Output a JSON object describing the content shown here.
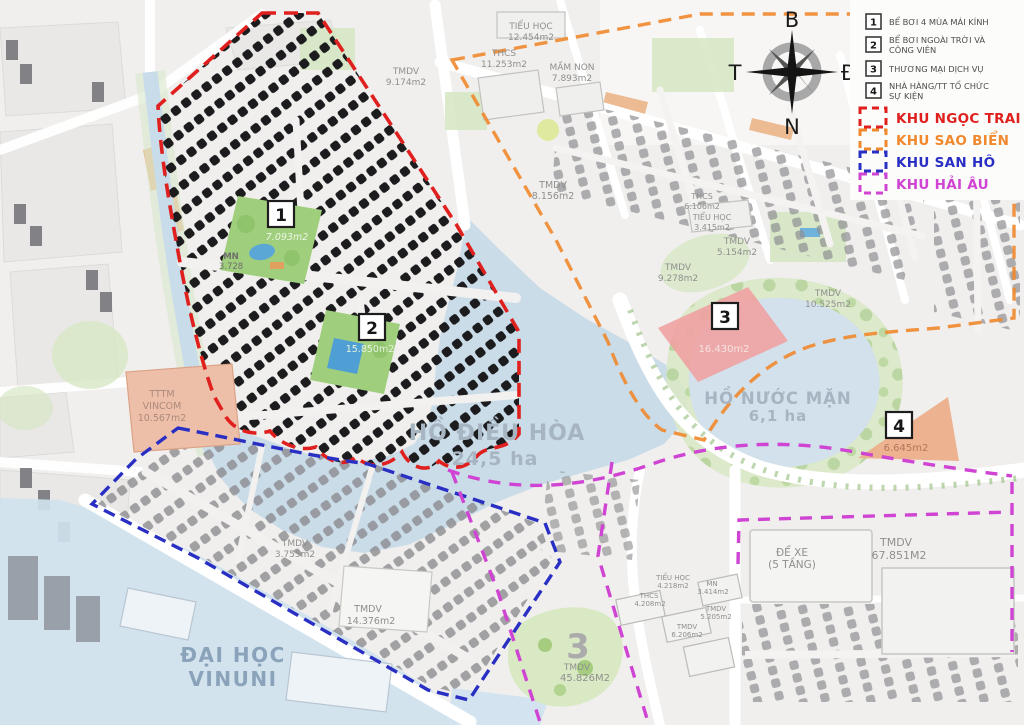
{
  "legend": {
    "items": [
      {
        "num": "1",
        "lines": [
          "BỂ BƠI 4 MÙA MÁI KÍNH"
        ]
      },
      {
        "num": "2",
        "lines": [
          "BỂ BƠI NGOÀI TRỜI VÀ",
          "CÔNG VIÊN"
        ]
      },
      {
        "num": "3",
        "lines": [
          "THƯƠNG MẠI DỊCH VỤ"
        ]
      },
      {
        "num": "4",
        "lines": [
          "NHÀ HÀNG/TT TỔ CHỨC",
          "SỰ KIỆN"
        ]
      }
    ],
    "zones": [
      {
        "label": "KHU NGỌC TRAI",
        "color": "#df201e"
      },
      {
        "label": "KHU SAO BIỂN",
        "color": "#f0882e"
      },
      {
        "label": "KHU SAN HÔ",
        "color": "#2a2fc4"
      },
      {
        "label": "KHU HẢI ÂU",
        "color": "#cf44d2"
      }
    ]
  },
  "compass": {
    "n": "B",
    "e": "Đ",
    "s": "N",
    "w": "T"
  },
  "lakes": {
    "dieu_hoa": {
      "name": "HỒ ĐIỀU HÒA",
      "area": "24,5 ha"
    },
    "nuoc_man": {
      "name": "HỒ NƯỚC MẶN",
      "area": "6,1 ha"
    }
  },
  "markers": {
    "m1": {
      "num": "1",
      "area": "7.093m2"
    },
    "m2": {
      "num": "2",
      "area": "15.850m2"
    },
    "m3": {
      "num": "3",
      "area": "16.430m2"
    },
    "m4": {
      "num": "4",
      "area": "6.645m2"
    },
    "m3b": {
      "num": "3",
      "name": "TMDV",
      "area": "45.826M2"
    }
  },
  "parcels": {
    "tieu_hoc_12454": {
      "line1": "TIỂU HỌC",
      "line2": "12.454m2"
    },
    "thcs_11253": {
      "line1": "THCS",
      "line2": "11.253m2"
    },
    "mam_non_7893": {
      "line1": "MẦM NON",
      "line2": "7.893m2"
    },
    "tmdv_9174": {
      "line1": "TMDV",
      "line2": "9.174m2"
    },
    "tmdv_8156": {
      "line1": "TMDV",
      "line2": "8.156m2"
    },
    "thcs_6106": {
      "line1": "THCS",
      "line2": "6.106m2"
    },
    "tieu_hoc_3415": {
      "line1": "TIỂU HỌC",
      "line2": "3.415m2"
    },
    "tmdv_5154": {
      "line1": "TMDV",
      "line2": "5.154m2"
    },
    "tmdv_9278": {
      "line1": "TMDV",
      "line2": "9.278m2"
    },
    "tmdv_10525": {
      "line1": "TMDV",
      "line2": "10.525m2"
    },
    "mn_3728": {
      "line1": "MN",
      "line2": "3.728"
    },
    "tttm_vincom": {
      "line1": "TTTM",
      "line2": "VINCOM",
      "line3": "10.567m2"
    },
    "tmdv_3755": {
      "line1": "TMDV",
      "line2": "3.755m2"
    },
    "tmdv_14376": {
      "line1": "TMDV",
      "line2": "14.376m2"
    },
    "dai_hoc_vinuni": {
      "line1": "ĐẠI HỌC",
      "line2": "VINUNI"
    },
    "thcs_4208": {
      "line1": "THCS",
      "line2": "4.208m2"
    },
    "tieu_hoc_4218": {
      "line1": "TIỂU HỌC",
      "line2": "4.218m2"
    },
    "mn_3414": {
      "line1": "MN",
      "line2": "3.414m2"
    },
    "tmdv_5205": {
      "line1": "TMDV",
      "line2": "5.205m2"
    },
    "tmdv_6206": {
      "line1": "TMDV",
      "line2": "6.206m2"
    },
    "de_xe": {
      "line1": "ĐỂ XE",
      "line2": "(5 TẦNG)"
    },
    "tmdv_67851": {
      "line1": "TMDV",
      "line2": "67.851M2"
    }
  }
}
